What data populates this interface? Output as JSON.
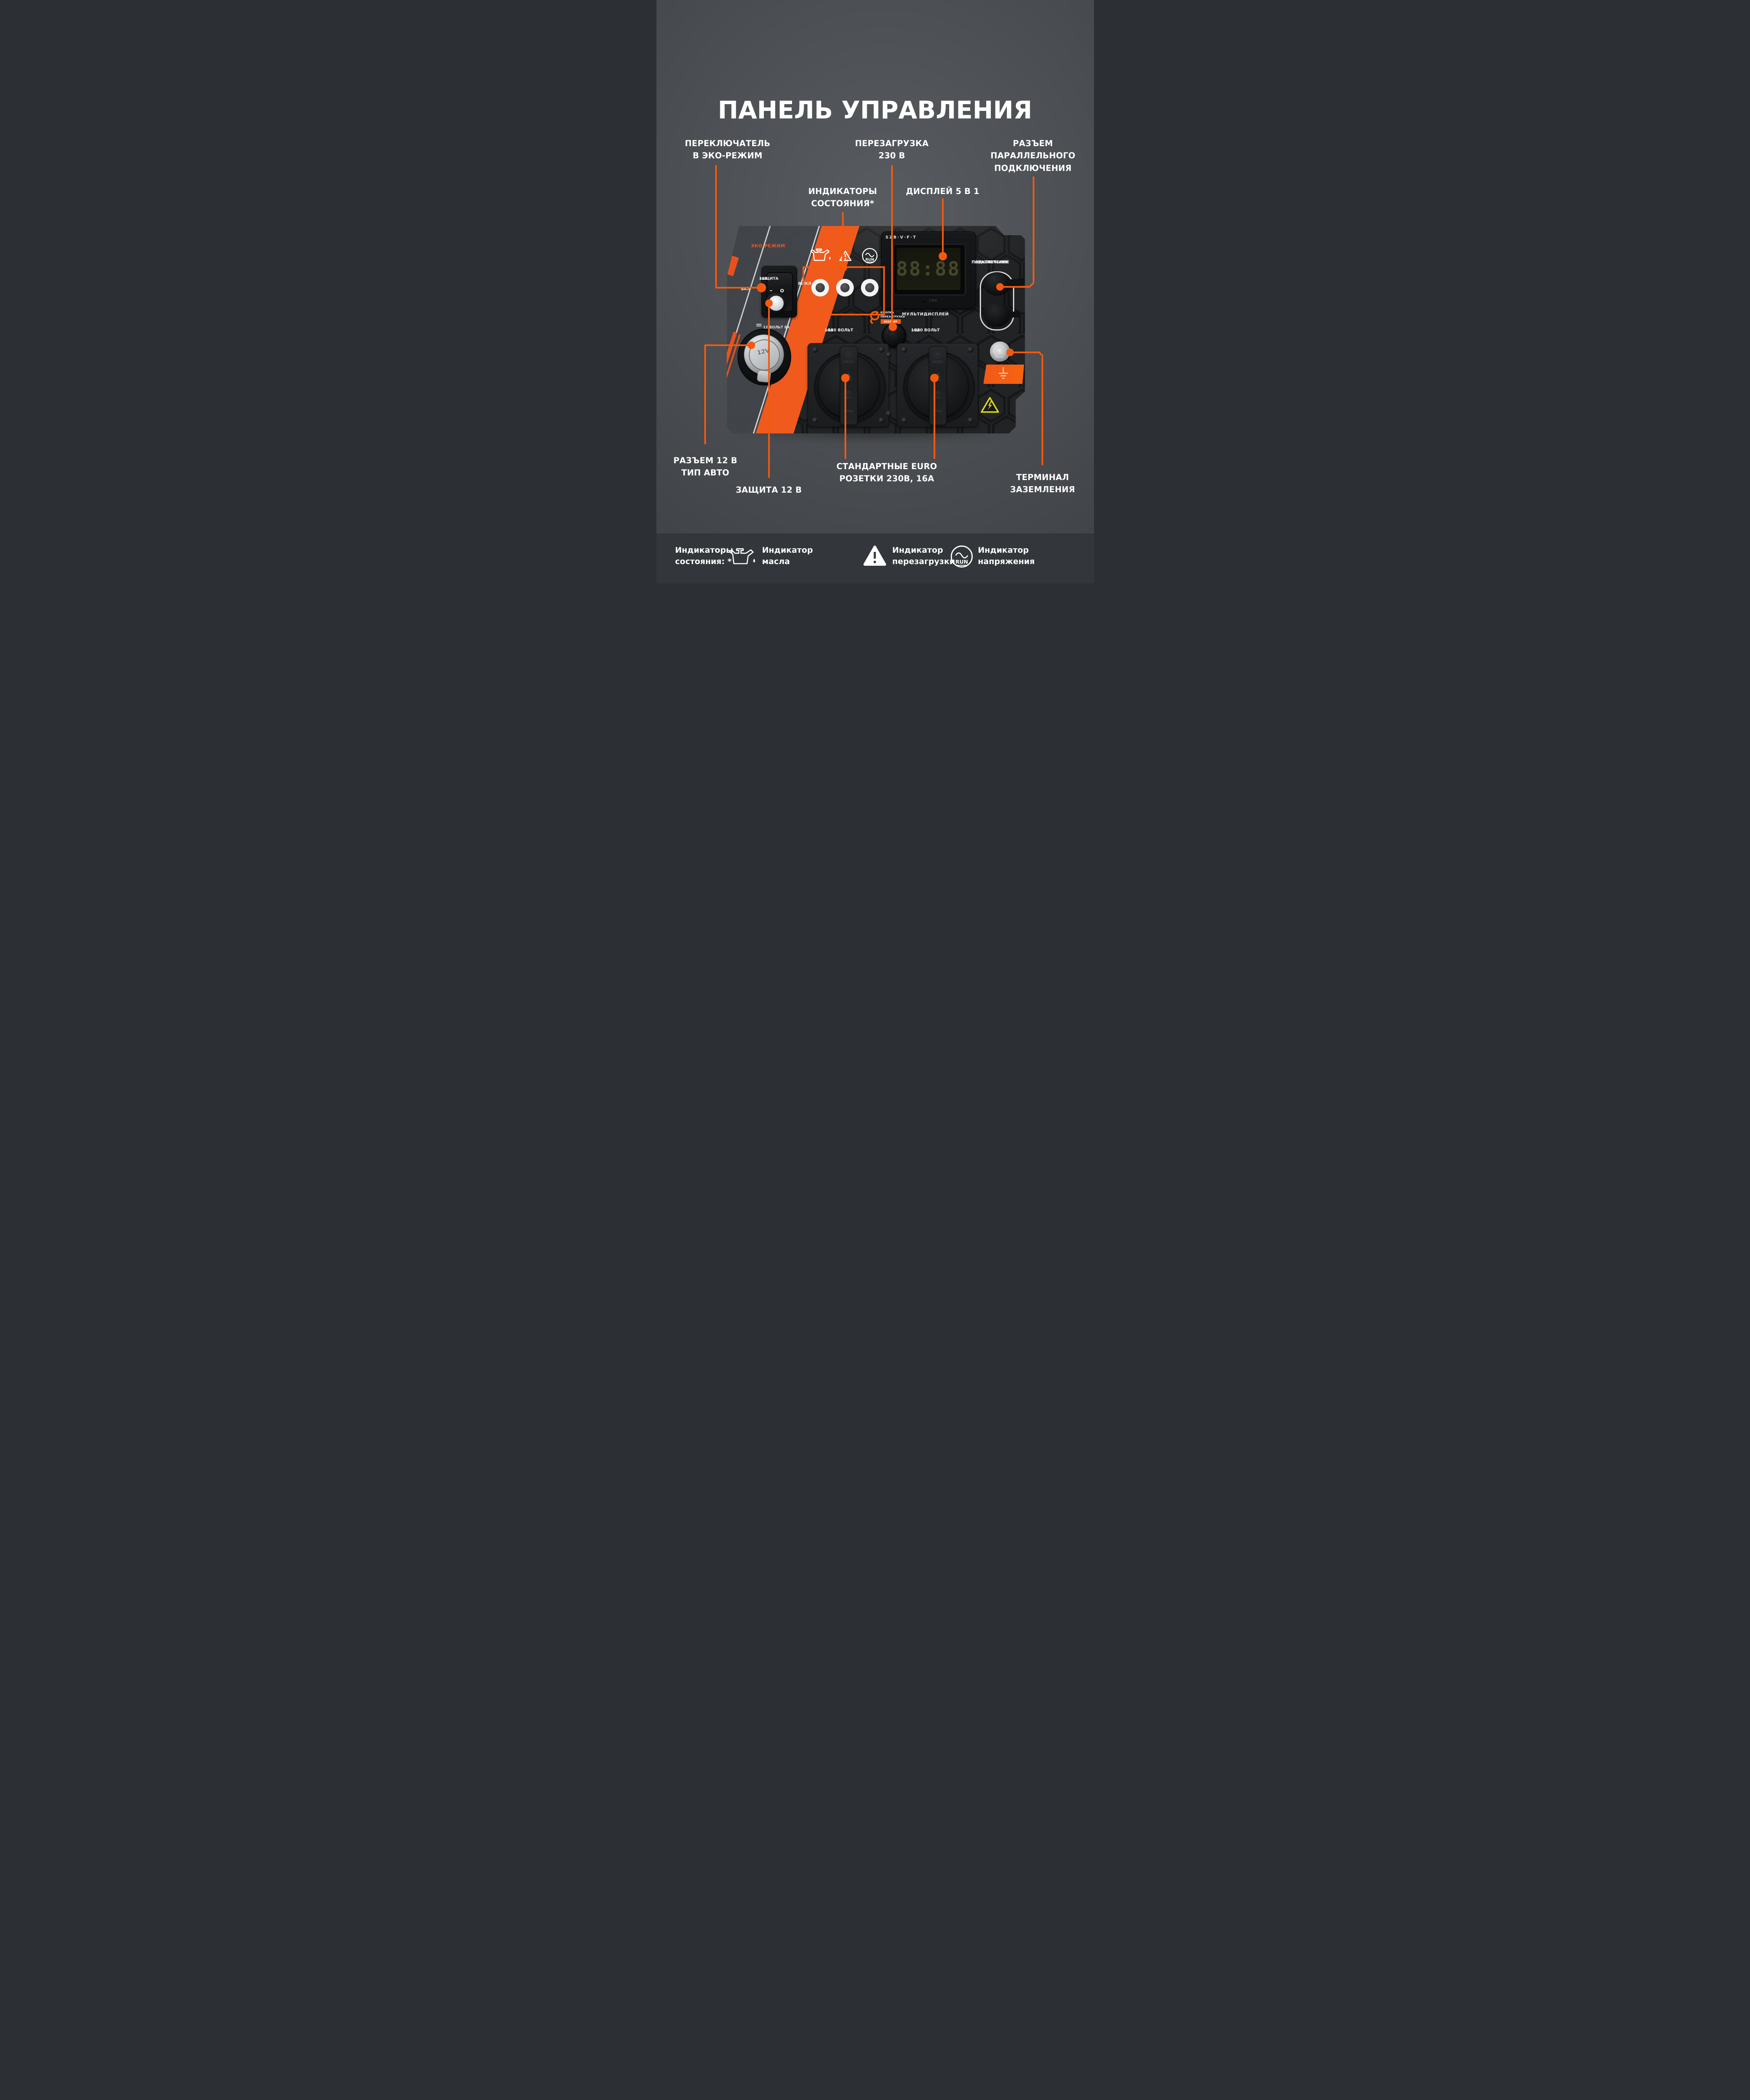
{
  "title": "ПАНЕЛЬ УПРАВЛЕНИЯ",
  "colors": {
    "accent": "#F4590E",
    "background": "#46494D",
    "footer": "#33363A",
    "panel": "#1E2022"
  },
  "callouts": {
    "eco_switch": {
      "line1": "ПЕРЕКЛЮЧАТЕЛЬ",
      "line2": "В ЭКО-РЕЖИМ"
    },
    "restart_230": {
      "line1": "ПЕРЕЗАГРУЗКА",
      "line2": "230 В"
    },
    "parallel": {
      "line1": "РАЗЪЕМ",
      "line2": "ПАРАЛЛЕЛЬНОГО",
      "line3": "ПОДКЛЮЧЕНИЯ"
    },
    "status_indicators": {
      "line1": "ИНДИКАТОРЫ",
      "line2": "СОСТОЯНИЯ*"
    },
    "display": {
      "line1": "ДИСПЛЕЙ 5 В 1"
    },
    "socket_12v": {
      "line1": "РАЗЪЕМ 12 В",
      "line2": "ТИП АВТО"
    },
    "protection_12v": {
      "line1": "ЗАЩИТА 12 В"
    },
    "euro_sockets": {
      "line1": "СТАНДАРТНЫЕ EURO",
      "line2": "РОЗЕТКИ 230В, 16А"
    },
    "ground": {
      "line1": "ТЕРМИНАЛ",
      "line2": "ЗАЗЕМЛЕНИЯ"
    }
  },
  "panel": {
    "eco_mode_label": "ЭКО-РЕЖИМ",
    "on_label": "ВКЛ",
    "off_label": "ВЫКЛ",
    "switch_dash": "–",
    "switch_circle": "O",
    "run_label": "RUN",
    "display_header": "SZB·V·F·T",
    "lcd_value": "88:88",
    "display_indicator_label": "CNA",
    "multidisplay_label": "МУЛЬТИДИСПЛЕЙ",
    "restart_btn_line1": "КНОПКА",
    "restart_btn_line2": "ПЕРЕЗАГРУЗКИ",
    "restart_btn_chip": "RESTART",
    "volt230_left_line1": "~230 ВОЛЬТ",
    "volt230_left_line2": "16А",
    "volt230_right_line1": "~230 ВОЛЬТ",
    "volt230_right_line2": "16А",
    "parallel_line1": "ПАРАЛЛЕЛЬНОЕ",
    "parallel_line2": "ПОДКЛЮЧЕНИЕ",
    "protection_line1": "ЗАЩИТА",
    "protection_line2": "12В",
    "volt12_label": "12 ВОЛЬТ 8А",
    "socket12v_cap": "12V",
    "socket_brand_letter": "G",
    "socket_brand": "GHGU",
    "socket_tuv": "TÜV",
    "socket_rating_top": "16",
    "socket_rating_bottom": "250~",
    "socket_ip": "IP44"
  },
  "legend": {
    "heading_line1": "Индикаторы",
    "heading_line2": "состояния: *",
    "items": [
      {
        "line1": "Индикатор",
        "line2": "масла"
      },
      {
        "line1": "Индикатор",
        "line2": "перезагрузки"
      },
      {
        "line1": "Индикатор",
        "line2": "напряжения"
      }
    ]
  }
}
